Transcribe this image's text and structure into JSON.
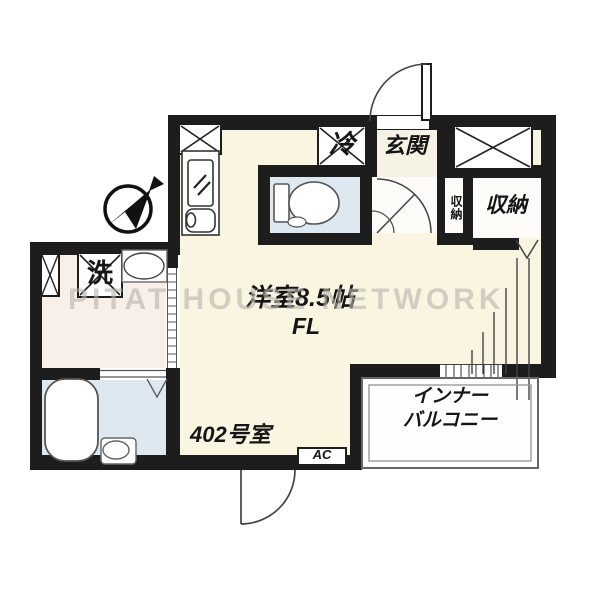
{
  "plan": {
    "type": "japanese-apartment-floorplan",
    "unit": "402号室"
  },
  "labels": {
    "entrance": "玄関",
    "refrigerator": "冷",
    "storage_small": "収納",
    "storage_large": "収納",
    "washer": "洗",
    "main_room": "洋室8.5帖",
    "flooring": "FL",
    "unit_number": "402号室",
    "balcony_line1": "インナー",
    "balcony_line2": "バルコニー",
    "ac": "AC",
    "watermark": "PITAT HOUSE NETWORK"
  },
  "compass": {
    "type": "north-arrow",
    "points": "northeast"
  },
  "colors": {
    "wall": "#1d1d1d",
    "room_floor": "#faf5e1",
    "entrance_floor": "#f7f3e4",
    "wet_floor": "#dde8f1",
    "washroom_floor": "#f8efe9",
    "balcony_floor": "#fefefe",
    "watermark_color": "#b9b5ac",
    "line": "#2a2a2a"
  }
}
